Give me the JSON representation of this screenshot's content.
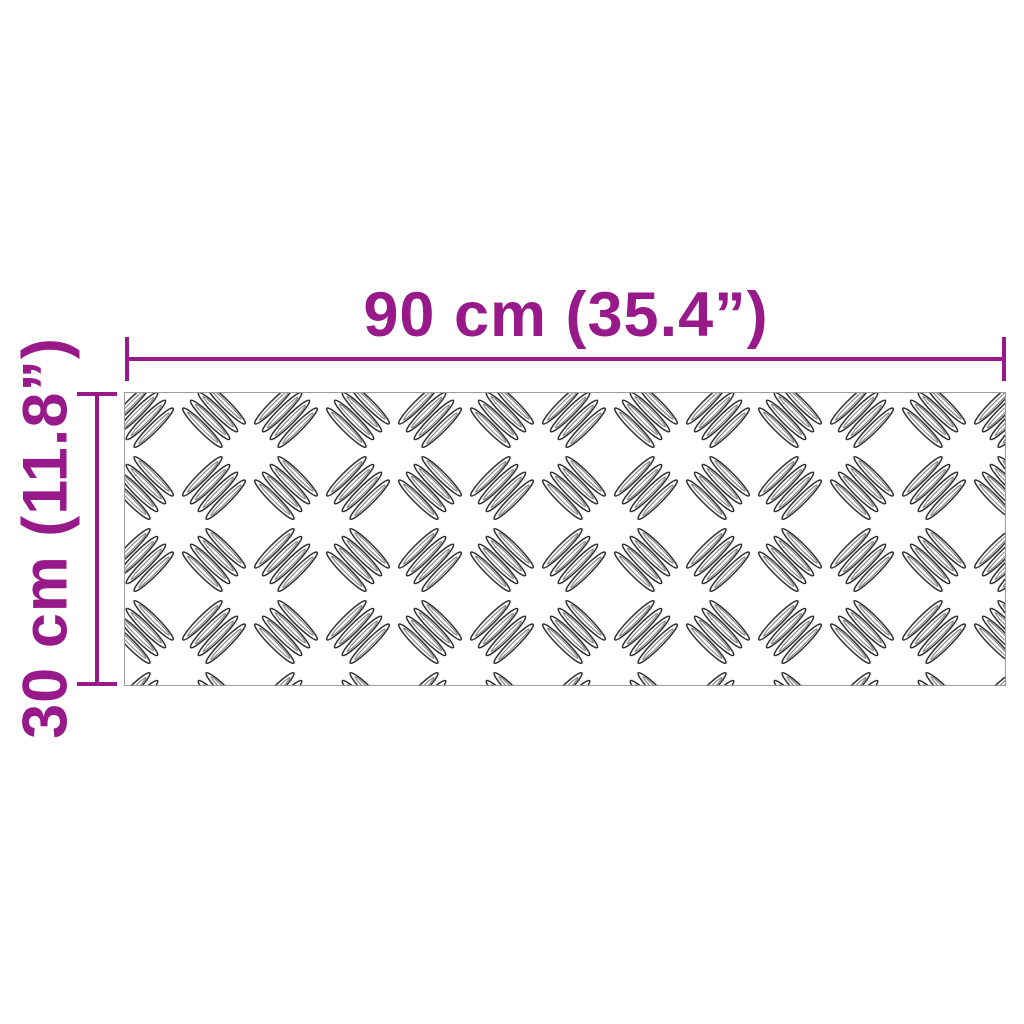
{
  "diagram": {
    "type": "product-dimension-diagram",
    "product_pattern": "aluminium-checker-plate",
    "width_label": "90 cm (35.4”)",
    "height_label": "30 cm (11.8”)",
    "width_cm": 90,
    "width_in": 35.4,
    "height_cm": 30,
    "height_in": 11.8,
    "accent_color": "#97198A",
    "plate_border_color": "#9c9c9c",
    "plate_fill_color": "#ffffff",
    "tread_stroke_color": "#2f2f2f",
    "background_color": "#ffffff"
  }
}
